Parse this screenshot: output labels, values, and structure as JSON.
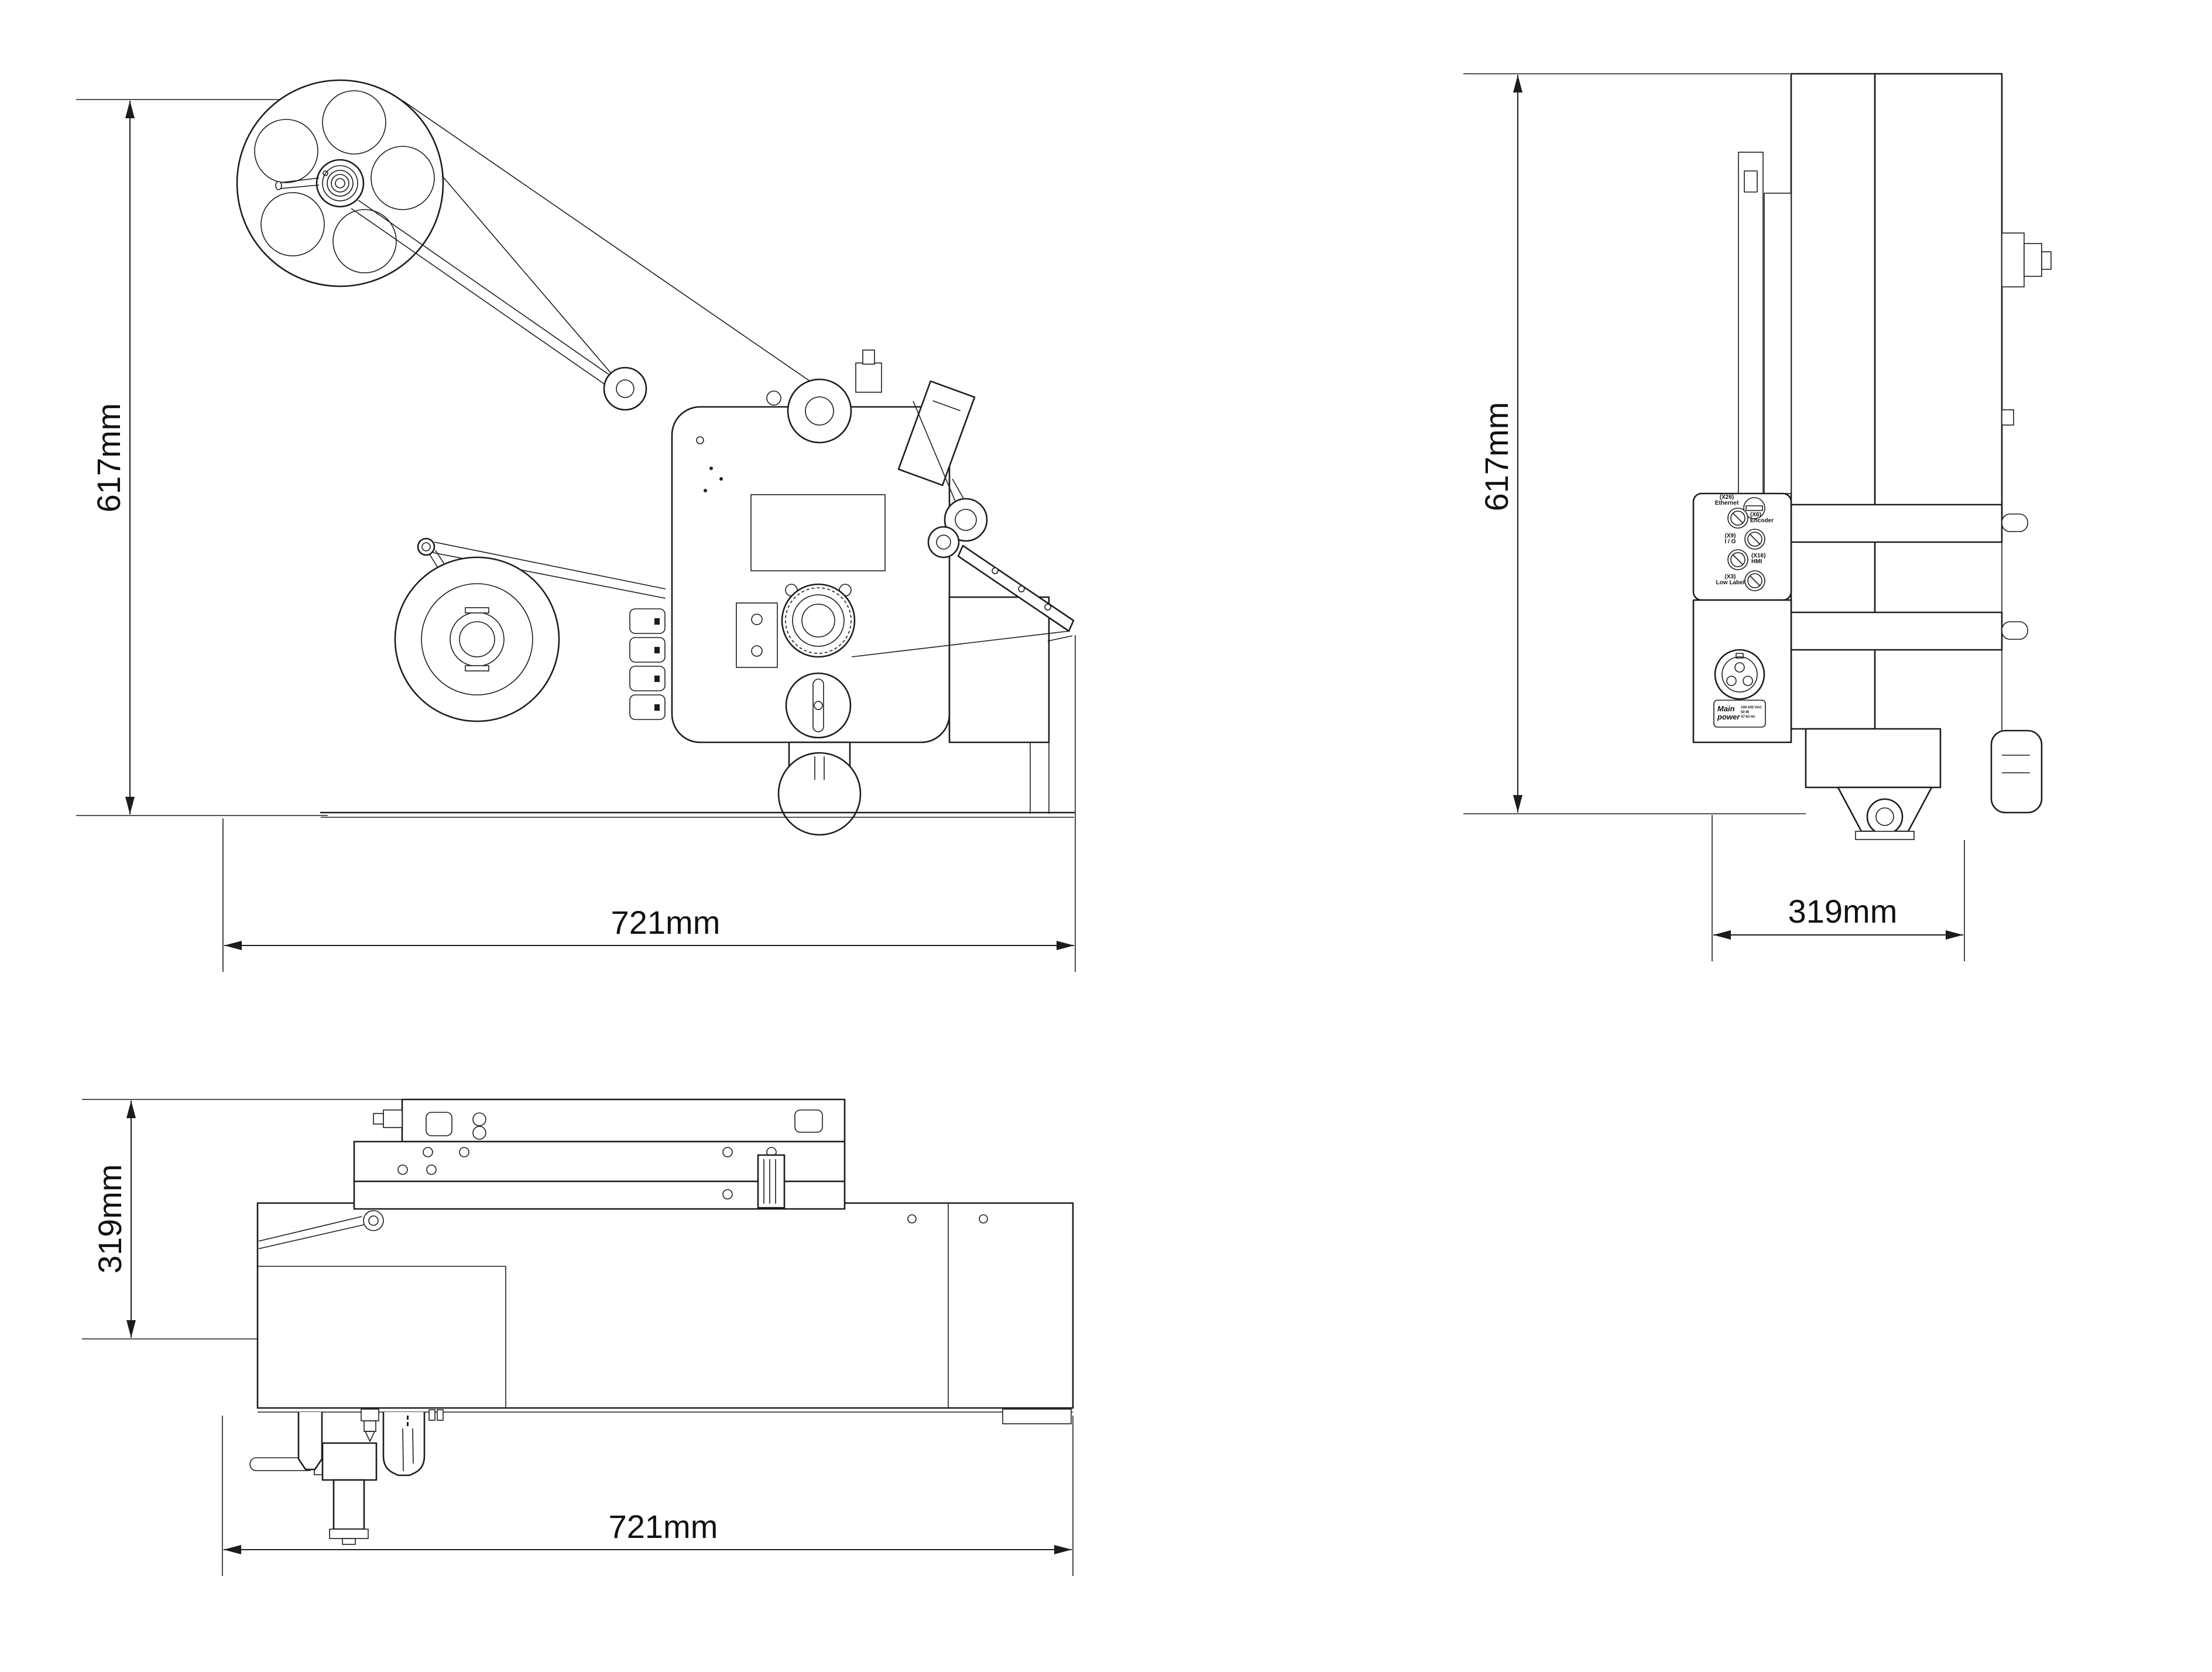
{
  "drawing": {
    "background": "#ffffff",
    "line_color": "#1c1c1c",
    "views": {
      "front": {
        "title": "front-view",
        "dims": {
          "height": "617mm",
          "width": "721mm"
        }
      },
      "side": {
        "title": "side-view",
        "dims": {
          "height": "617mm",
          "depth": "319mm"
        }
      },
      "top": {
        "title": "top-view",
        "dims": {
          "depth": "319mm",
          "width": "721mm"
        }
      }
    },
    "connector_panel": {
      "connectors": [
        {
          "id": "(X26)",
          "name": "Ethernet"
        },
        {
          "id": "(X6)",
          "name": "Encoder"
        },
        {
          "id": "(X9)",
          "name": "I / O"
        },
        {
          "id": "(X16)",
          "name": "HMI"
        },
        {
          "id": "(X3)",
          "name": "Low Label"
        }
      ],
      "power": {
        "title_line1": "Main",
        "title_line2": "power",
        "specs": [
          "100-240 VAC",
          "50 W",
          "47-63 Hz"
        ]
      }
    }
  }
}
